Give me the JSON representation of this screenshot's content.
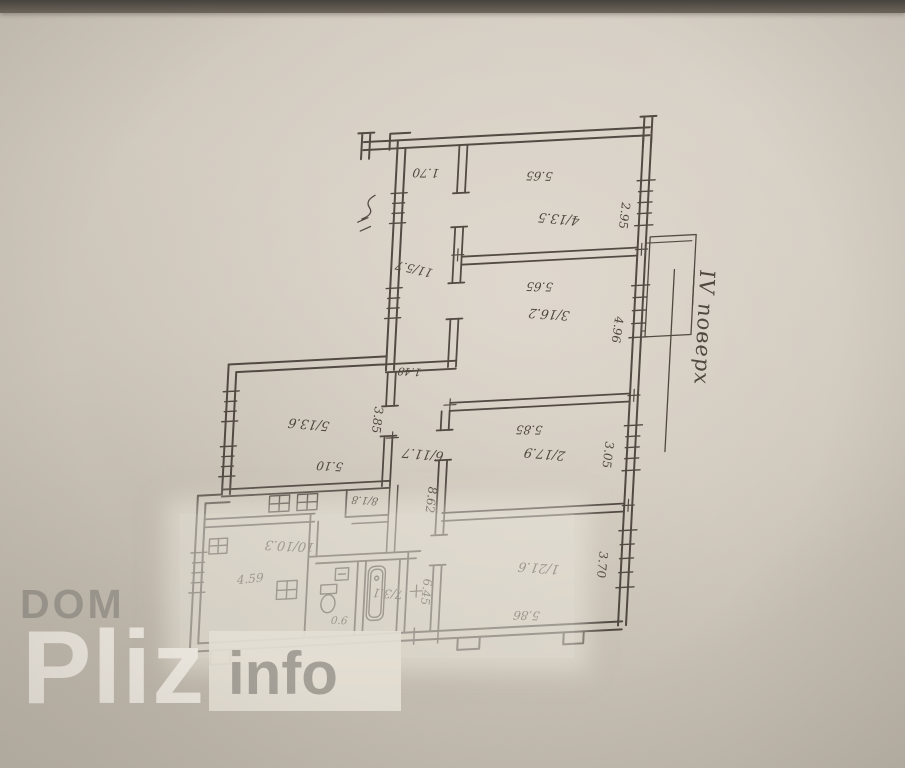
{
  "document": {
    "type": "apartment floor plan (technical passport sheet, photographed)",
    "floor_label": "IV поверх"
  },
  "watermark": {
    "dom": "DOM",
    "pliz": "Pliz",
    "info": "info"
  },
  "rooms": [
    {
      "number": "4",
      "area": "13.5",
      "label": "4/13.5"
    },
    {
      "number": "3",
      "area": "16.2",
      "label": "3/16.2"
    },
    {
      "number": "2",
      "area": "17.9",
      "label": "2/17.9"
    },
    {
      "number": "1",
      "area": "21.6",
      "label": "1/21.6"
    },
    {
      "number": "5",
      "area": "13.6",
      "label": "5/13.6"
    },
    {
      "number": "6",
      "area": "11.7",
      "label": "6/11.7"
    },
    {
      "number": "11",
      "area": "5.7",
      "label": "11/5.7"
    },
    {
      "number": "8",
      "area": "1.8",
      "label": "8/1.8"
    },
    {
      "number": "7",
      "area": "3.1",
      "label": "7/3.1"
    },
    {
      "number": "10",
      "area": "10.3",
      "label": "10/10.3"
    }
  ],
  "dims": {
    "corridor_width": "1.70",
    "room4_width": "5.65",
    "room4_depth": "2.95",
    "room3_width": "5.65",
    "room3_depth": "4.96",
    "room2_width": "5.85",
    "room2_depth": "3.05",
    "room1_width": "5.86",
    "room1_depth": "3.70",
    "room5_width": "5.10",
    "room5_depth": "3.85",
    "corridor_length": "8.62",
    "corridor_lower": "6.45",
    "kitchen_width": "4.59",
    "door_width": "0.6",
    "passage": "1.48"
  },
  "ink_color": "#453f36",
  "paper_color": "#cfc8bc"
}
